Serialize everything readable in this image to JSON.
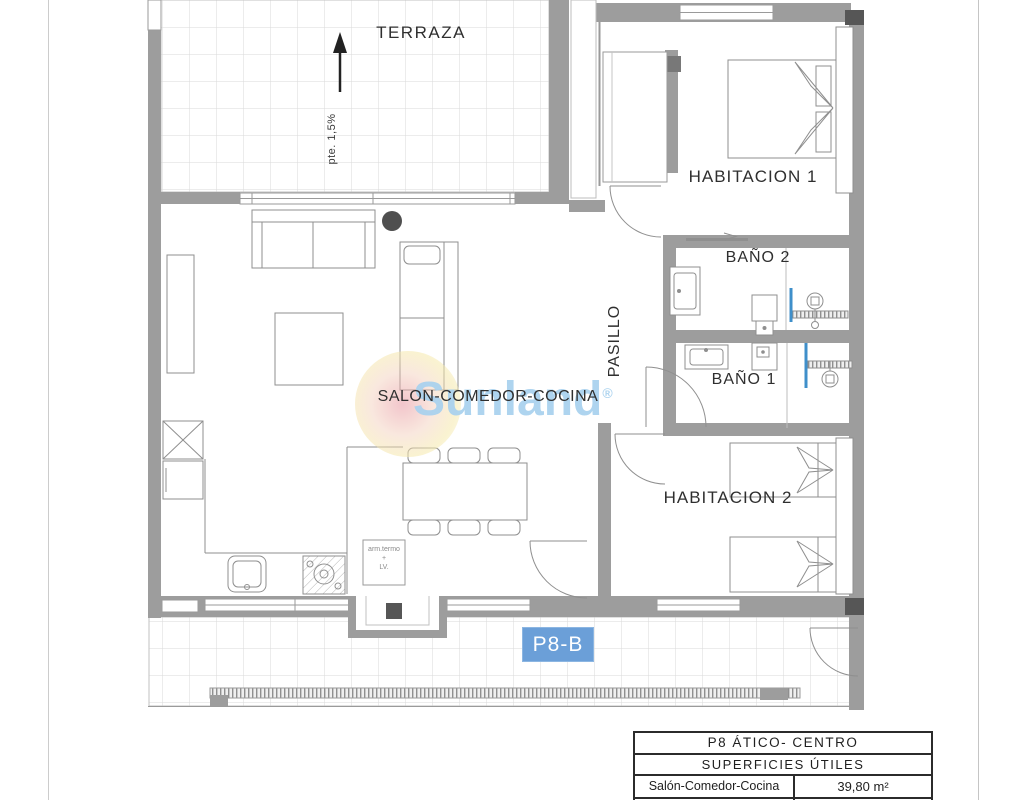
{
  "plan": {
    "labels": {
      "terraza": "TERRAZA",
      "slope": "pte. 1,5%",
      "habitacion1": "HABITACION 1",
      "bano2": "BAÑO 2",
      "bano1": "BAÑO 1",
      "pasillo": "PASILLO",
      "salon": "SALON-COMEDOR-COCINA",
      "habitacion2": "HABITACION 2"
    },
    "appliance_note": {
      "line1": "arm.termo",
      "line2": "+",
      "line3": "LV."
    },
    "unit_badge": "P8-B"
  },
  "watermark": {
    "brand": "Sunland",
    "registered": "®"
  },
  "info_table": {
    "title": "P8 ÁTICO- CENTRO",
    "subtitle": "SUPERFICIES ÚTILES",
    "rows": [
      {
        "label": "Salón-Comedor-Cocina",
        "area": "39,80 m²"
      }
    ]
  },
  "colors": {
    "wall_gray": "#9d9d9d",
    "badge_blue": "#6b9fd8",
    "watermark_blue": "#a7d0ee",
    "shower_screen_blue": "#3f8fca",
    "dark_fixture": "#565656"
  }
}
